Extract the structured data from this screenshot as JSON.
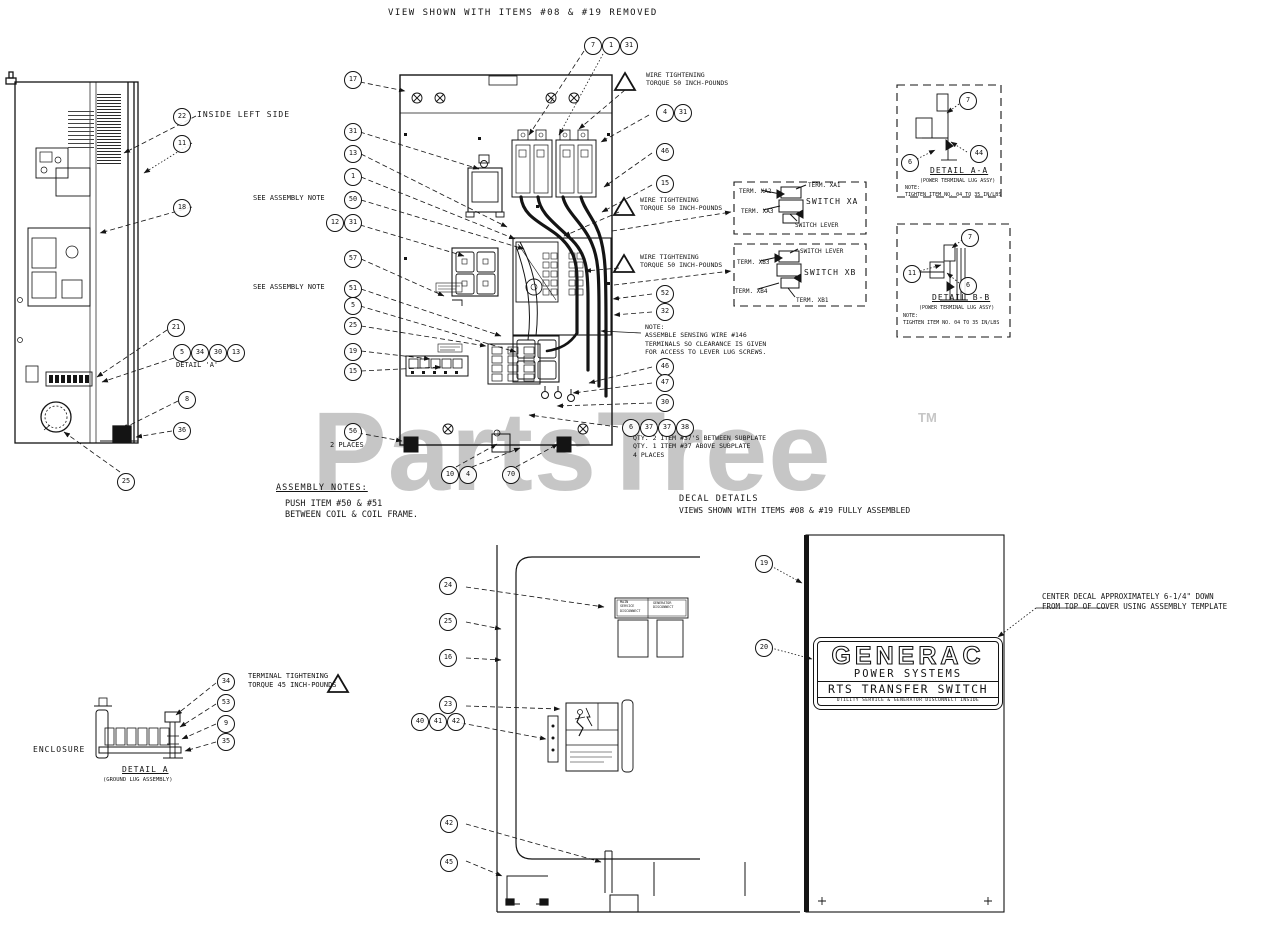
{
  "watermark": {
    "text": "PartsTree",
    "tm": "TM",
    "color": "#c6c6c6"
  },
  "generac_decal": {
    "brand": "GENERAC",
    "sub": "POWER SYSTEMS",
    "product": "RTS TRANSFER SWITCH",
    "footnote": "UTILITY SERVICE & GENERATOR DISCONNECT INSIDE"
  },
  "texts": [
    {
      "id": "view-title",
      "x": 388,
      "y": 8,
      "size": 9,
      "ls": 1.5,
      "text": "VIEW SHOWN WITH ITEMS #08 & #19 REMOVED"
    },
    {
      "id": "inside-left-side",
      "x": 197,
      "y": 110,
      "size": 8,
      "ls": 1,
      "text": "INSIDE LEFT SIDE"
    },
    {
      "id": "detail-a-ref",
      "x": 176,
      "y": 361,
      "size": 7,
      "text": "DETAIL 'A'"
    },
    {
      "id": "see-note-50",
      "x": 253,
      "y": 194,
      "size": 7,
      "text": "SEE ASSEMBLY NOTE"
    },
    {
      "id": "see-note-51",
      "x": 253,
      "y": 283,
      "size": 7,
      "text": "SEE ASSEMBLY NOTE"
    },
    {
      "id": "two-places",
      "x": 330,
      "y": 441,
      "size": 7,
      "text": "2 PLACES"
    },
    {
      "id": "warn-top",
      "x": 646,
      "y": 71,
      "size": 6.5,
      "text": "WIRE TIGHTENING\nTORQUE 50 INCH-POUNDS"
    },
    {
      "id": "warn-mid",
      "x": 640,
      "y": 196,
      "size": 6.5,
      "text": "WIRE TIGHTENING\nTORQUE 50 INCH-POUNDS"
    },
    {
      "id": "warn-low",
      "x": 640,
      "y": 253,
      "size": 6.5,
      "text": "WIRE TIGHTENING\nTORQUE 50 INCH-POUNDS"
    },
    {
      "id": "sensing-note",
      "x": 645,
      "y": 323,
      "size": 6.5,
      "text": "NOTE:\nASSEMBLE SENSING WIRE #146\nTERMINALS SO CLEARANCE IS GIVEN\nFOR ACCESS TO LEVER LUG SCREWS."
    },
    {
      "id": "qty-note",
      "x": 633,
      "y": 434,
      "size": 6.5,
      "text": "QTY. 2 ITEM #37'S BETWEEN SUBPLATE\nQTY. 1 ITEM #37 ABOVE SUBPLATE\n4 PLACES"
    },
    {
      "id": "term-xa2",
      "x": 739,
      "y": 188,
      "size": 6,
      "text": "TERM. XA2"
    },
    {
      "id": "term-xa1",
      "x": 808,
      "y": 182,
      "size": 6,
      "text": "TERM. XA1"
    },
    {
      "id": "switch-xa",
      "x": 806,
      "y": 197,
      "size": 8,
      "ls": 1,
      "text": "SWITCH XA"
    },
    {
      "id": "term-xa3",
      "x": 741,
      "y": 208,
      "size": 6,
      "text": "TERM. XA3"
    },
    {
      "id": "switch-lever-a",
      "x": 795,
      "y": 222,
      "size": 6,
      "text": "SWITCH LEVER"
    },
    {
      "id": "switch-lever-b",
      "x": 800,
      "y": 248,
      "size": 6,
      "text": "SWITCH LEVER"
    },
    {
      "id": "term-xb3",
      "x": 737,
      "y": 259,
      "size": 6,
      "text": "TERM. XB3"
    },
    {
      "id": "switch-xb",
      "x": 804,
      "y": 268,
      "size": 8,
      "ls": 1,
      "text": "SWITCH XB"
    },
    {
      "id": "term-xb4",
      "x": 735,
      "y": 288,
      "size": 6,
      "text": "TERM. XB4"
    },
    {
      "id": "term-xb1",
      "x": 796,
      "y": 297,
      "size": 6,
      "text": "TERM. XB1"
    },
    {
      "id": "detail-aa-title",
      "x": 930,
      "y": 166,
      "size": 8,
      "ls": 1,
      "underline": true,
      "text": "DETAIL A-A"
    },
    {
      "id": "detail-aa-sub",
      "x": 920,
      "y": 178,
      "size": 5,
      "text": "(POWER TERMINAL LUG ASSY)"
    },
    {
      "id": "detail-aa-note",
      "x": 905,
      "y": 185,
      "size": 5,
      "text": "NOTE:\nTIGHTEN ITEM NO. 04 TO 35 IN/LBS"
    },
    {
      "id": "detail-bb-title",
      "x": 932,
      "y": 293,
      "size": 8,
      "ls": 1,
      "underline": true,
      "text": "DETAIL B-B"
    },
    {
      "id": "detail-bb-sub",
      "x": 919,
      "y": 305,
      "size": 5,
      "text": "(POWER TERMINAL LUG ASSY)"
    },
    {
      "id": "detail-bb-note",
      "x": 903,
      "y": 313,
      "size": 5,
      "text": "NOTE:\nTIGHTEN ITEM NO. 04 TO 35 IN/LBS"
    },
    {
      "id": "assembly-notes",
      "x": 276,
      "y": 483,
      "size": 8.5,
      "ls": 1,
      "underline": true,
      "text": "ASSEMBLY NOTES:"
    },
    {
      "id": "assembly-notes-body",
      "x": 285,
      "y": 499,
      "size": 8.5,
      "text": "PUSH ITEM #50 & #51\nBETWEEN COIL & COIL FRAME."
    },
    {
      "id": "decal-details",
      "x": 679,
      "y": 494,
      "size": 8.5,
      "ls": 1,
      "text": "DECAL DETAILS"
    },
    {
      "id": "decal-details-sub",
      "x": 679,
      "y": 506,
      "size": 8,
      "text": "VIEWS SHOWN WITH ITEMS #08 & #19 FULLY ASSEMBLED"
    },
    {
      "id": "center-decal-note",
      "x": 1042,
      "y": 592,
      "size": 7.5,
      "text": "CENTER DECAL APPROXIMATELY 6-1/4\" DOWN\nFROM TOP OF COVER USING ASSEMBLY TEMPLATE"
    },
    {
      "id": "terminal-torque",
      "x": 248,
      "y": 672,
      "size": 7,
      "text": "TERMINAL TIGHTENING\nTORQUE 45 INCH-POUNDS"
    },
    {
      "id": "enclosure",
      "x": 33,
      "y": 745,
      "size": 8,
      "ls": 1,
      "text": "ENCLOSURE"
    },
    {
      "id": "detail-a-title",
      "x": 122,
      "y": 765,
      "size": 8,
      "ls": 1,
      "underline": true,
      "text": "DETAIL A"
    },
    {
      "id": "detail-a-sub",
      "x": 103,
      "y": 777,
      "size": 5.5,
      "text": "(GROUND LUG ASSEMBLY)"
    },
    {
      "id": "decal-small-1",
      "x": 620,
      "y": 600,
      "size": 3.4,
      "text": "MAIN\nSERVICE\nDISCONNECT"
    },
    {
      "id": "decal-small-2",
      "x": 653,
      "y": 601,
      "size": 3.4,
      "text": "GENERATOR\nDISCONNECT"
    }
  ],
  "callouts": [
    {
      "x": 181,
      "y": 116,
      "label": "22"
    },
    {
      "x": 181,
      "y": 143,
      "label": "11"
    },
    {
      "x": 181,
      "y": 207,
      "label": "18"
    },
    {
      "x": 175,
      "y": 327,
      "label": "21"
    },
    {
      "x": 181,
      "y": 352,
      "label": "5"
    },
    {
      "x": 199,
      "y": 352,
      "label": "34"
    },
    {
      "x": 217,
      "y": 352,
      "label": "30"
    },
    {
      "x": 235,
      "y": 352,
      "label": "13"
    },
    {
      "x": 186,
      "y": 399,
      "label": "8"
    },
    {
      "x": 181,
      "y": 430,
      "label": "36"
    },
    {
      "x": 125,
      "y": 481,
      "label": "25"
    },
    {
      "x": 352,
      "y": 79,
      "label": "17"
    },
    {
      "x": 352,
      "y": 131,
      "label": "31"
    },
    {
      "x": 352,
      "y": 153,
      "label": "13"
    },
    {
      "x": 352,
      "y": 176,
      "label": "1"
    },
    {
      "x": 352,
      "y": 199,
      "label": "50"
    },
    {
      "x": 334,
      "y": 222,
      "label": "12"
    },
    {
      "x": 352,
      "y": 222,
      "label": "31"
    },
    {
      "x": 352,
      "y": 258,
      "label": "57"
    },
    {
      "x": 352,
      "y": 288,
      "label": "51"
    },
    {
      "x": 352,
      "y": 305,
      "label": "5"
    },
    {
      "x": 352,
      "y": 325,
      "label": "25"
    },
    {
      "x": 352,
      "y": 351,
      "label": "19"
    },
    {
      "x": 352,
      "y": 371,
      "label": "15"
    },
    {
      "x": 352,
      "y": 431,
      "label": "56"
    },
    {
      "x": 449,
      "y": 474,
      "label": "10"
    },
    {
      "x": 467,
      "y": 474,
      "label": "4"
    },
    {
      "x": 510,
      "y": 474,
      "label": "70"
    },
    {
      "x": 592,
      "y": 45,
      "label": "7"
    },
    {
      "x": 610,
      "y": 45,
      "label": "1"
    },
    {
      "x": 628,
      "y": 45,
      "label": "31"
    },
    {
      "x": 664,
      "y": 112,
      "label": "4"
    },
    {
      "x": 682,
      "y": 112,
      "label": "31"
    },
    {
      "x": 664,
      "y": 151,
      "label": "46"
    },
    {
      "x": 664,
      "y": 183,
      "label": "15"
    },
    {
      "x": 664,
      "y": 293,
      "label": "52"
    },
    {
      "x": 664,
      "y": 311,
      "label": "32"
    },
    {
      "x": 664,
      "y": 366,
      "label": "46"
    },
    {
      "x": 664,
      "y": 382,
      "label": "47"
    },
    {
      "x": 664,
      "y": 402,
      "label": "30"
    },
    {
      "x": 630,
      "y": 427,
      "label": "6"
    },
    {
      "x": 648,
      "y": 427,
      "label": "37"
    },
    {
      "x": 666,
      "y": 427,
      "label": "37"
    },
    {
      "x": 684,
      "y": 427,
      "label": "38"
    },
    {
      "x": 967,
      "y": 100,
      "label": "7"
    },
    {
      "x": 978,
      "y": 153,
      "label": "44"
    },
    {
      "x": 909,
      "y": 162,
      "label": "6"
    },
    {
      "x": 969,
      "y": 237,
      "label": "7"
    },
    {
      "x": 911,
      "y": 273,
      "label": "11"
    },
    {
      "x": 967,
      "y": 285,
      "label": "6"
    },
    {
      "x": 447,
      "y": 585,
      "label": "24"
    },
    {
      "x": 447,
      "y": 621,
      "label": "25"
    },
    {
      "x": 447,
      "y": 657,
      "label": "16"
    },
    {
      "x": 447,
      "y": 704,
      "label": "23"
    },
    {
      "x": 419,
      "y": 721,
      "label": "40"
    },
    {
      "x": 437,
      "y": 721,
      "label": "41"
    },
    {
      "x": 455,
      "y": 721,
      "label": "42"
    },
    {
      "x": 448,
      "y": 823,
      "label": "42"
    },
    {
      "x": 448,
      "y": 862,
      "label": "45"
    },
    {
      "x": 763,
      "y": 563,
      "label": "19"
    },
    {
      "x": 763,
      "y": 647,
      "label": "20"
    },
    {
      "x": 225,
      "y": 681,
      "label": "34"
    },
    {
      "x": 225,
      "y": 702,
      "label": "53"
    },
    {
      "x": 225,
      "y": 723,
      "label": "9"
    },
    {
      "x": 225,
      "y": 741,
      "label": "35"
    }
  ]
}
